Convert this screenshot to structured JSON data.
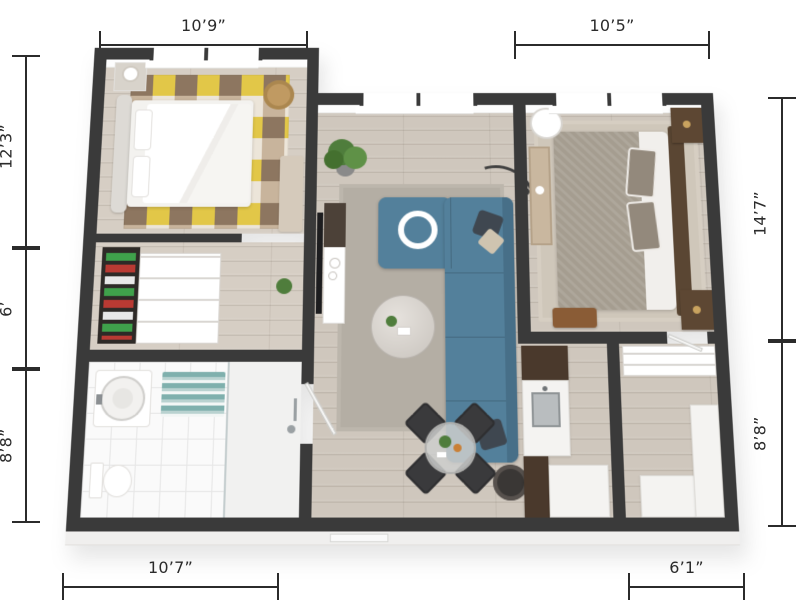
{
  "dimensions": {
    "top_left": "10’9”",
    "top_right": "10’5”",
    "left_upper": "12’3”",
    "left_middle": "6’",
    "left_lower": "8’8”",
    "right_upper": "14’7”",
    "right_lower": "8’8”",
    "bottom_left": "10’7”",
    "bottom_right": "6’1”"
  },
  "colors": {
    "bg": "#ffffff",
    "dim": "#2b2b2b",
    "wall": "#3a3a3a",
    "floor_wood": "#cfc7bd",
    "bedroom_floor": "#d6cec4",
    "tile": "#fafafa",
    "tile_line": "#e6e6e6",
    "rug_yellow": "#e2c748",
    "rug_cream": "#ece5d9",
    "rug_tan": "#c8b49c",
    "rug_brown": "#8d7660",
    "living_rug": "#b4aea4",
    "sofa": "#53809b",
    "sofa_dark": "#476f88",
    "bed_white": "#f3f2ef",
    "bed2_taupe": "#a59d90",
    "wood_dark": "#5a4633",
    "cabinet_walnut": "#4a392c",
    "mat_teal": "#7fb0ad",
    "chair_dark": "#3a3a3c",
    "plant_green": "#4f7d3c",
    "counter_white": "#f4f3f1",
    "base": "#f0efee"
  }
}
